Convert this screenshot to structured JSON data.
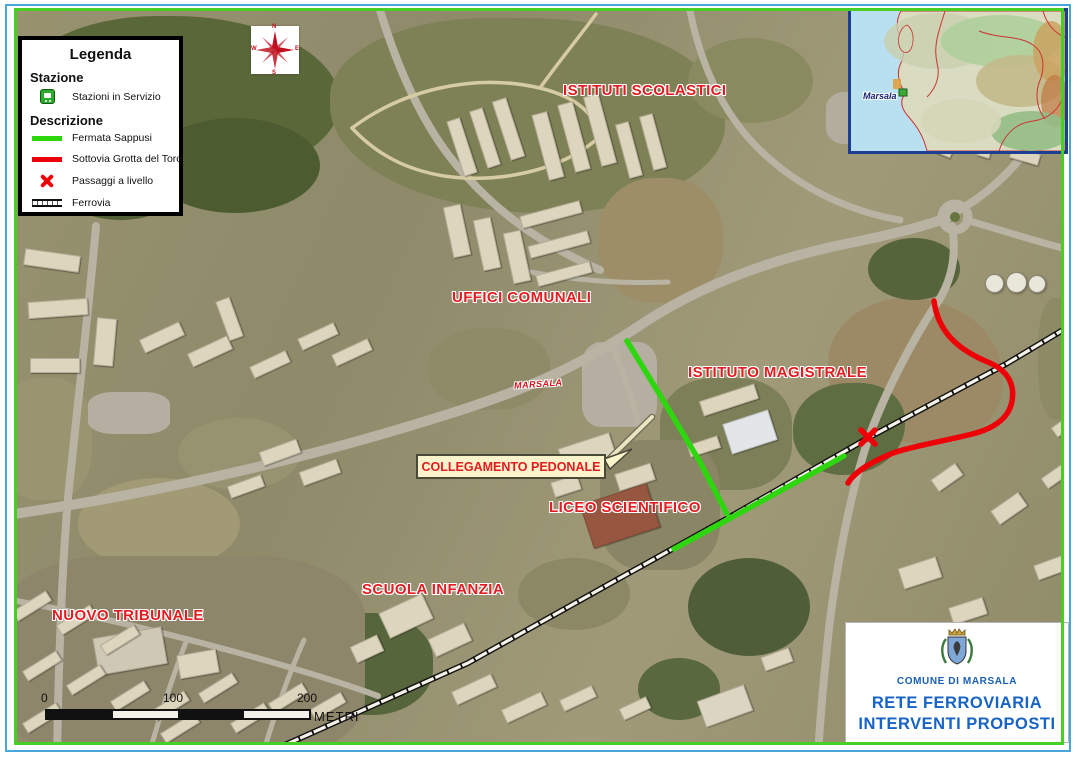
{
  "title_block": {
    "municipality": "COMUNE DI MARSALA",
    "line1": "RETE FERROVIARIA",
    "line2": "INTERVENTI PROPOSTI"
  },
  "legend": {
    "title": "Legenda",
    "station_section": "Stazione",
    "station_item": "Stazioni in Servizio",
    "description_section": "Descrizione",
    "items": [
      {
        "label": "Fermata Sappusi",
        "swatch": "green-line",
        "color": "#2ed60e"
      },
      {
        "label": "Sottovia Grotta del Toro",
        "swatch": "red-line",
        "color": "#ee0008"
      },
      {
        "label": "Passaggi a livello",
        "swatch": "red-x",
        "color": "#ee0008"
      },
      {
        "label": "Ferrovia",
        "swatch": "railway"
      }
    ]
  },
  "map_labels": [
    {
      "text": "ISTITUTI SCOLASTICI"
    },
    {
      "text": "UFFICI COMUNALI"
    },
    {
      "text": "ISTITUTO MAGISTRALE"
    },
    {
      "text": "LICEO SCIENTIFICO"
    },
    {
      "text": "SCUOLA INFANZIA"
    },
    {
      "text": "NUOVO TRIBUNALE"
    }
  ],
  "road_label": "MARSALA",
  "callout": {
    "text": "COLLEGAMENTO PEDONALE"
  },
  "inset": {
    "place_label": "Marsala"
  },
  "compass": {
    "north": "N",
    "east": "E",
    "south": "S",
    "west": "W"
  },
  "scale_bar": {
    "ticks": [
      "0",
      "100",
      "200"
    ],
    "unit": "METRI"
  },
  "colors": {
    "label_red": "#e41b20",
    "proposal_green": "#2ed60e",
    "proposal_red": "#ee0008",
    "map_border_green": "#47cf23",
    "frame_blue": "#49a6d9",
    "title_blue": "#1763c6"
  }
}
